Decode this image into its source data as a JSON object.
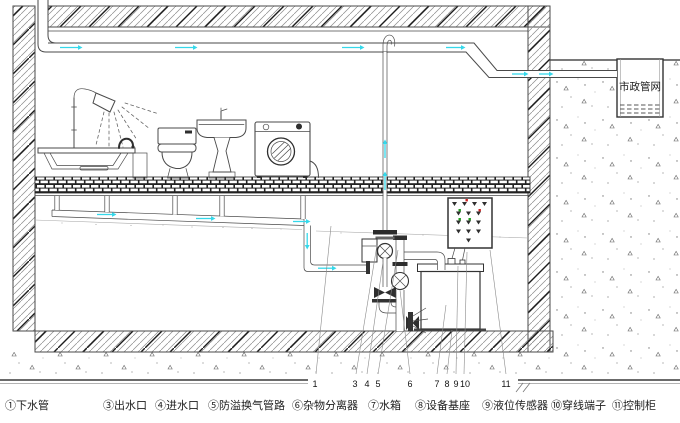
{
  "title": "污水提升设备安装示意图",
  "municipal_label": "市政管网",
  "legend": {
    "items": [
      "①下水管",
      "③出水口",
      "④进水口",
      "⑤防溢换气管路",
      "⑥杂物分离器",
      "⑦水箱",
      "⑧设备基座",
      "⑨液位传感器",
      "⑩穿线端子",
      "⑪控制柜"
    ]
  },
  "callouts": [
    "1",
    "3",
    "4",
    "5",
    "6",
    "7",
    "8",
    "9",
    "10",
    "11"
  ],
  "colors": {
    "flow_arrow": "#35d8ea",
    "line": "#4a4a4a",
    "indicator_green": "#1f9d1f",
    "indicator_red": "#cf2222",
    "background": "#ffffff"
  }
}
